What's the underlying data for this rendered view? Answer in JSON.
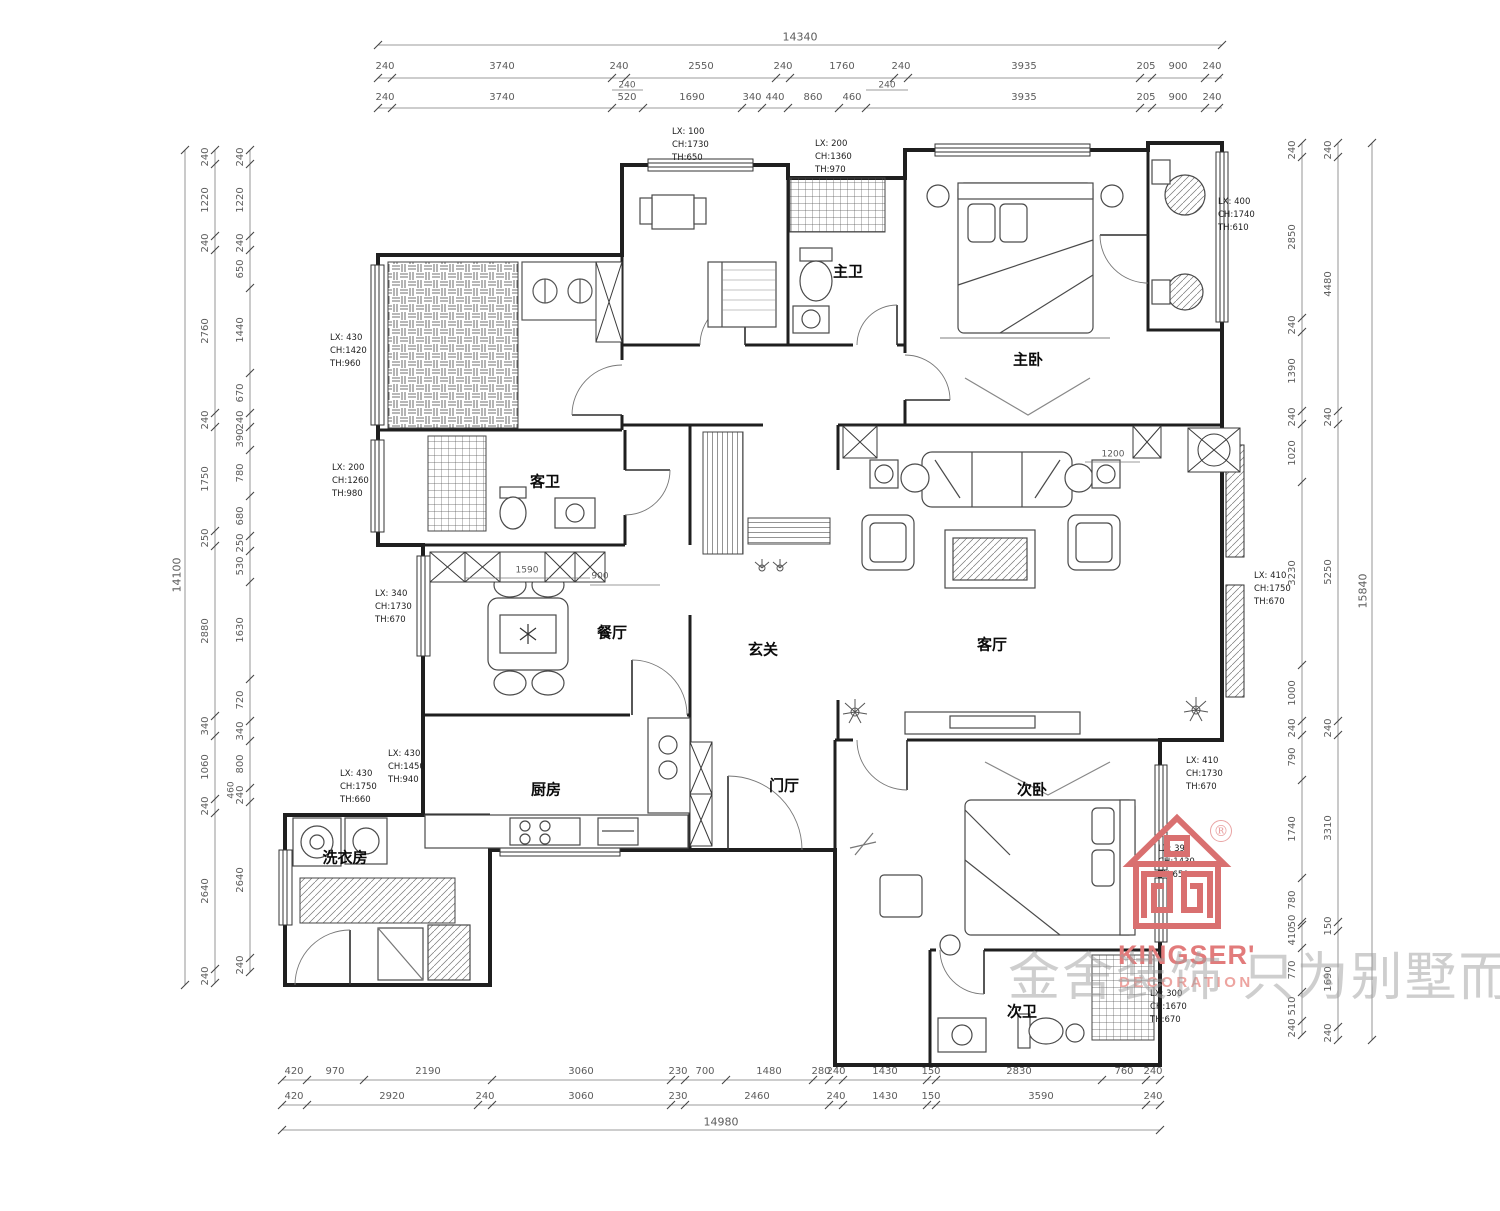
{
  "dims": {
    "top_total": "14340",
    "top_row1": [
      "240",
      "3740",
      "240",
      "2550",
      "240",
      "1760",
      "240",
      "3935",
      "205",
      "900",
      "240"
    ],
    "top_jogs": [
      "240",
      "240"
    ],
    "top_row2": [
      "240",
      "3740",
      "520",
      "1690",
      "340",
      "440",
      "860",
      "460",
      "3935",
      "205",
      "900",
      "240"
    ],
    "left_total": "14100",
    "left_outer": [
      "240",
      "1220",
      "240",
      "2760",
      "240",
      "1750",
      "250",
      "2880",
      "340",
      "1060",
      "240",
      "2640",
      "240"
    ],
    "left_jog": "460",
    "left_inner": [
      "240",
      "1220",
      "240",
      "650",
      "1440",
      "670",
      "240",
      "390",
      "780",
      "680",
      "250",
      "530",
      "1630",
      "720",
      "340",
      "800",
      "240",
      "2640",
      "240"
    ],
    "right_total": "15840",
    "right_inner": [
      "240",
      "2850",
      "240",
      "1390",
      "240",
      "1020",
      "3230",
      "1000",
      "240",
      "790",
      "1740",
      "780",
      "50",
      "410",
      "770",
      "510",
      "240"
    ],
    "right_middle": [
      "240",
      "4480",
      "240",
      "5250",
      "240",
      "3310",
      "150",
      "1690",
      "240"
    ],
    "bottom_row1": [
      "420",
      "970",
      "2190",
      "3060",
      "230",
      "700",
      "1480",
      "280",
      "240",
      "1430",
      "150",
      "2830",
      "760",
      "240"
    ],
    "bottom_row2": [
      "420",
      "2920",
      "240",
      "3060",
      "230",
      "2460",
      "240",
      "1430",
      "150",
      "3590",
      "240"
    ],
    "bottom_total": "14980",
    "interior": [
      "1590",
      "900",
      "1200"
    ]
  },
  "rooms": [
    {
      "label": "主卫"
    },
    {
      "label": "主卧"
    },
    {
      "label": "客卫"
    },
    {
      "label": "餐厅"
    },
    {
      "label": "玄关"
    },
    {
      "label": "客厅"
    },
    {
      "label": "厨房"
    },
    {
      "label": "门厅"
    },
    {
      "label": "洗衣房"
    },
    {
      "label": "次卧"
    },
    {
      "label": "次卫"
    }
  ],
  "window_tags": [
    {
      "l1": "LX: 100",
      "l2": "CH:1730",
      "l3": "TH:650"
    },
    {
      "l1": "LX: 200",
      "l2": "CH:1360",
      "l3": "TH:970"
    },
    {
      "l1": "LX: 400",
      "l2": "CH:1740",
      "l3": "TH:610"
    },
    {
      "l1": "LX: 430",
      "l2": "CH:1420",
      "l3": "TH:960"
    },
    {
      "l1": "LX: 200",
      "l2": "CH:1260",
      "l3": "TH:980"
    },
    {
      "l1": "LX: 340",
      "l2": "CH:1730",
      "l3": "TH:670"
    },
    {
      "l1": "LX: 430",
      "l2": "CH:1450",
      "l3": "TH:940"
    },
    {
      "l1": "LX: 430",
      "l2": "CH:1750",
      "l3": "TH:660"
    },
    {
      "l1": "LX: 410",
      "l2": "CH:1750",
      "l3": "TH:670"
    },
    {
      "l1": "LX: 410",
      "l2": "CH:1730",
      "l3": "TH:670"
    },
    {
      "l1": "LX: 390",
      "l2": "CH:1430",
      "l3": "TH:650"
    },
    {
      "l1": "LX: 300",
      "l2": "CH:1670",
      "l3": "TH:670"
    }
  ],
  "branding": {
    "registered": "®",
    "brand": "KINGSER'",
    "sub": "DECORATION",
    "watermark": "金舍装饰 只为别墅而生。",
    "accent": "#d45f5f"
  }
}
